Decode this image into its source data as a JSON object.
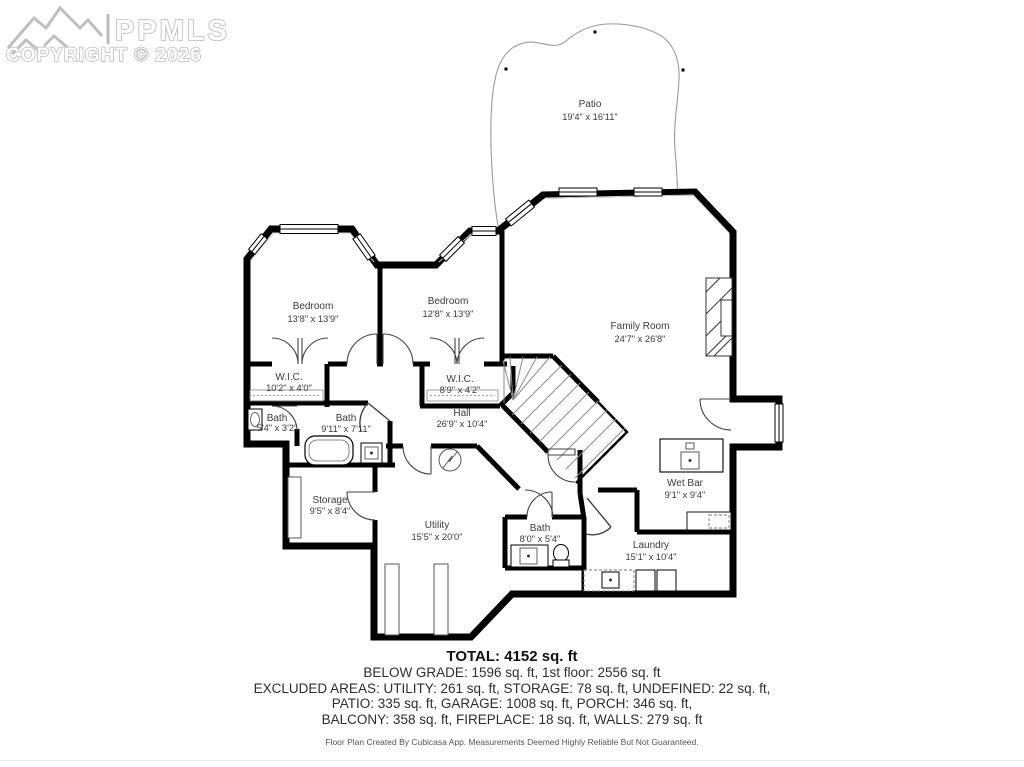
{
  "watermark": {
    "brand": "PPMLS",
    "copyright": "COPYRIGHT © 2026"
  },
  "patio": {
    "name": "Patio",
    "dims": "19'4\" x 16'11\""
  },
  "rooms": [
    {
      "id": "bedroom-1",
      "name": "Bedroom",
      "dims": "13'8\" x 13'9\""
    },
    {
      "id": "bedroom-2",
      "name": "Bedroom",
      "dims": "12'8\" x 13'9\""
    },
    {
      "id": "family-room",
      "name": "Family Room",
      "dims": "24'7\" x 26'8\""
    },
    {
      "id": "wic-1",
      "name": "W.I.C.",
      "dims": "10'2\" x 4'0\""
    },
    {
      "id": "wic-2",
      "name": "W.I.C.",
      "dims": "8'9\" x 4'2\""
    },
    {
      "id": "bath-1",
      "name": "Bath",
      "dims": "5'4\" x 3'2\""
    },
    {
      "id": "bath-2",
      "name": "Bath",
      "dims": "9'11\" x 7'11\""
    },
    {
      "id": "hall",
      "name": "Hall",
      "dims": "26'9\" x 10'4\""
    },
    {
      "id": "storage",
      "name": "Storage",
      "dims": "9'5\" x 8'4\""
    },
    {
      "id": "utility",
      "name": "Utility",
      "dims": "15'5\" x 20'0\""
    },
    {
      "id": "bath-3",
      "name": "Bath",
      "dims": "8'0\" x 5'4\""
    },
    {
      "id": "wet-bar",
      "name": "Wet Bar",
      "dims": "9'1\" x 9'4\""
    },
    {
      "id": "laundry",
      "name": "Laundry",
      "dims": "15'1\" x 10'4\""
    }
  ],
  "summary": {
    "total": "TOTAL: 4152 sq. ft",
    "line1": "BELOW GRADE: 1596 sq. ft, 1st floor: 2556 sq. ft",
    "line2": "EXCLUDED AREAS: UTILITY: 261 sq. ft, STORAGE: 78 sq. ft, UNDEFINED: 22 sq. ft,",
    "line3": "PATIO: 335 sq. ft, GARAGE: 1008 sq. ft, PORCH: 346 sq. ft,",
    "line4": "BALCONY: 358 sq. ft, FIREPLACE: 18 sq. ft, WALLS: 279 sq. ft",
    "footnote": "Floor Plan Created By Cubicasa App. Measurements Deemed Highly Reliable But Not Guaranteed."
  },
  "colors": {
    "wall": "#000000",
    "thin": "#999999",
    "label": "#3b3b3b",
    "watermark": "#b9b9b9"
  }
}
